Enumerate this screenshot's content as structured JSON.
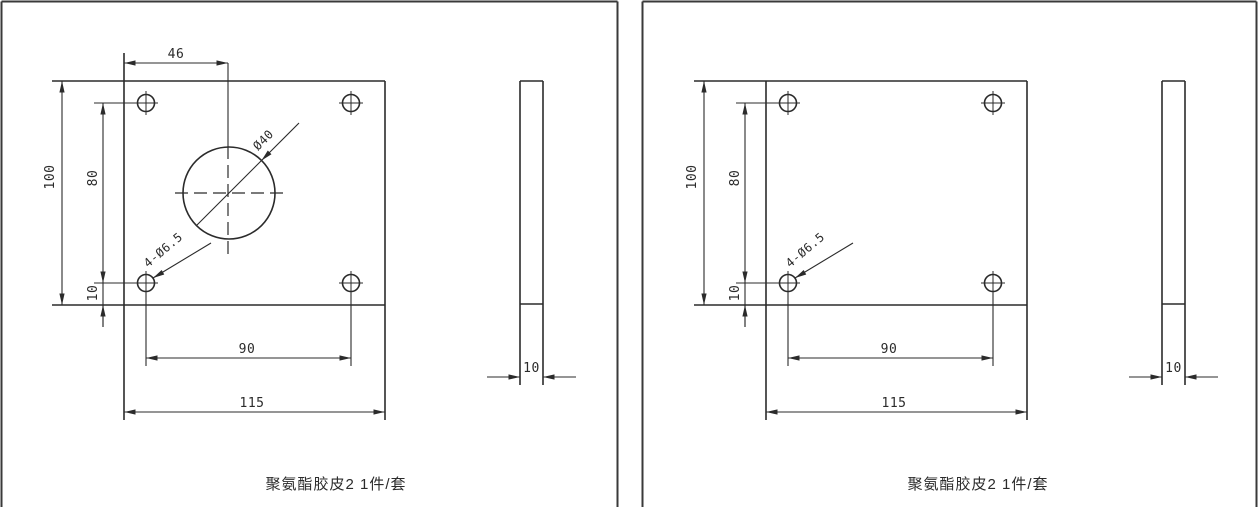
{
  "sheet": {
    "panels": [
      {
        "caption": "聚氨酯胶皮2 1件/套",
        "dimensions": {
          "center_offset_x": "46",
          "plate_height": "100",
          "hole_span_vertical": "80",
          "hole_edge_offset": "10",
          "corner_holes_label": "4-Ø6.5",
          "center_hole_diameter": "Ø40",
          "hole_span_horizontal": "90",
          "plate_width": "115",
          "thickness": "10"
        }
      },
      {
        "caption": "聚氨酯胶皮2 1件/套",
        "dimensions": {
          "plate_height": "100",
          "hole_span_vertical": "80",
          "hole_edge_offset": "10",
          "corner_holes_label": "4-Ø6.5",
          "hole_span_horizontal": "90",
          "plate_width": "115",
          "thickness": "10"
        }
      }
    ],
    "colors": {
      "line": "#2b2b2b",
      "background": "#ffffff"
    }
  }
}
